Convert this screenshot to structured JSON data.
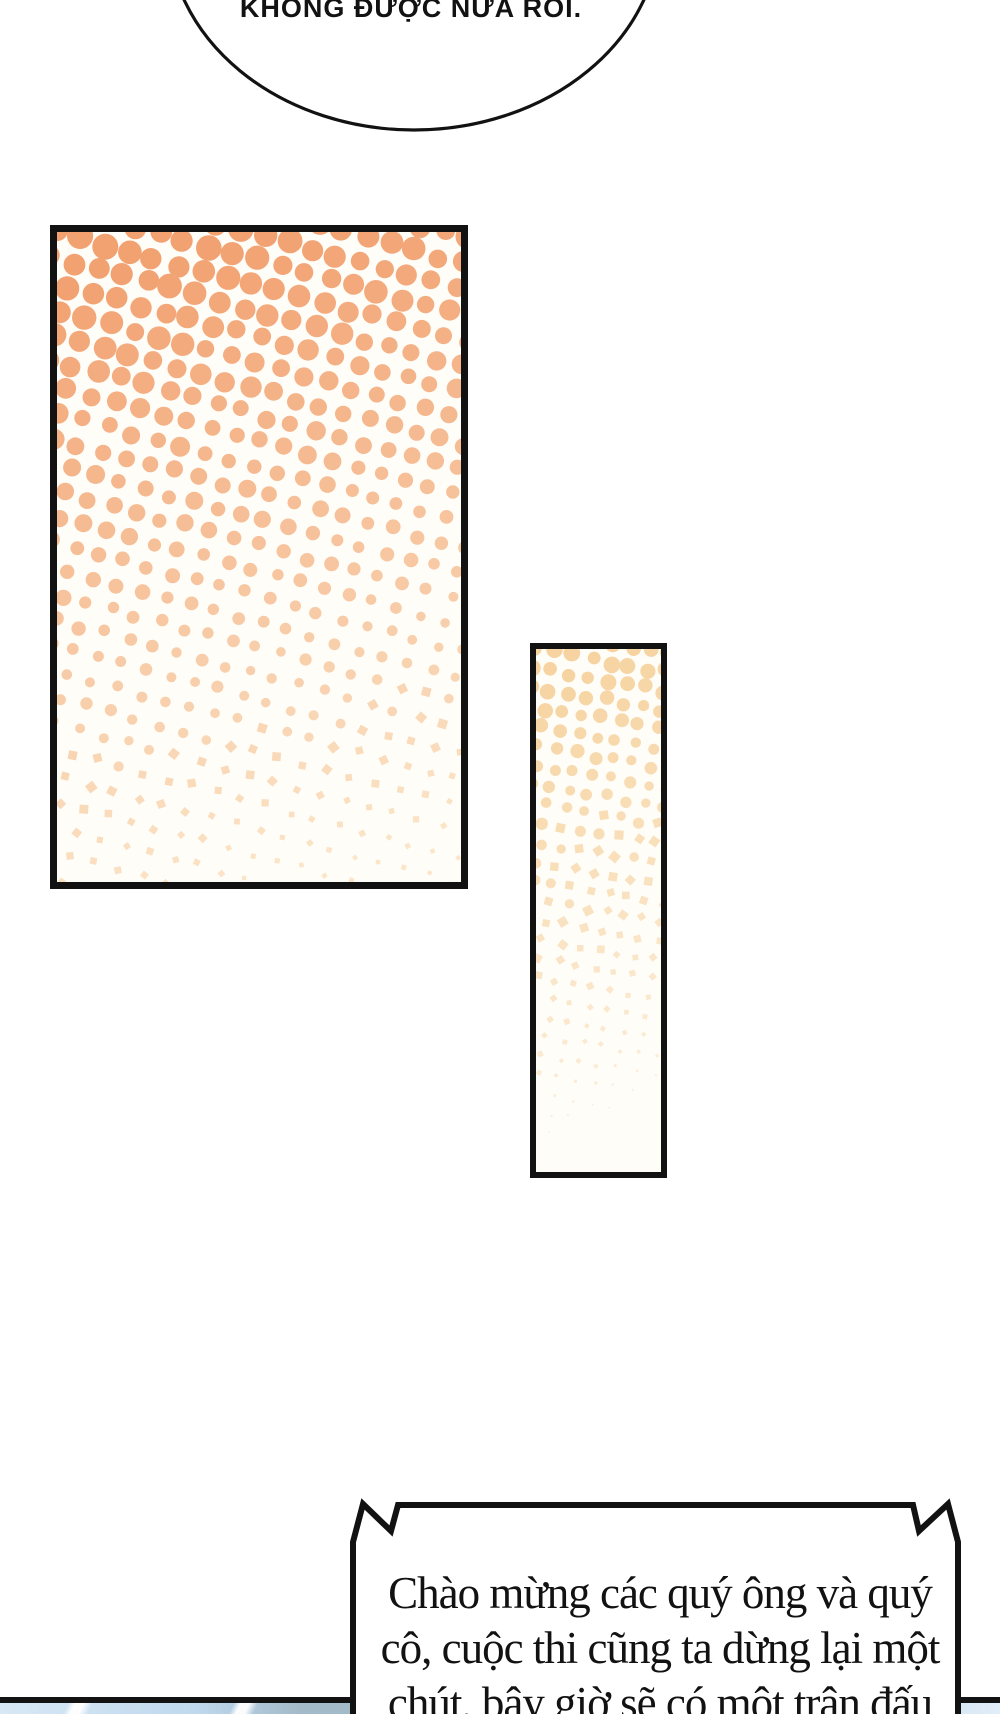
{
  "bubble": {
    "text": "KHÔNG ĐƯỢC NỮA RỒI."
  },
  "announcement": {
    "lines": [
      "Chào mừng các quý ông và quý",
      "cô, cuộc thi cũng ta dừng lại một",
      "chút, bây giờ sẽ có một trận đấu"
    ]
  },
  "halftone_panels": {
    "large": {
      "width": 404,
      "height": 650,
      "spacing": 25,
      "rotation": 15,
      "r_max": 11.5,
      "r_min": 2.4,
      "color_top": "#f2a171",
      "color_bottom": "#fbe6c9",
      "x_fade": 0.15,
      "vanish": false,
      "seed": 11
    },
    "small": {
      "width": 125,
      "height": 523,
      "spacing": 19,
      "rotation": 10,
      "r_max": 7.5,
      "r_min": 0.4,
      "color_top": "#f6d3a0",
      "color_bottom": "#fdf2e2",
      "x_fade": 0.1,
      "vanish": true,
      "seed": 5
    }
  },
  "colors": {
    "ink": "#121212",
    "paper": "#ffffff",
    "sky_light": "#d8e8f5",
    "sky_mid": "#c0d9ee",
    "sky_dark": "#a3bac9"
  }
}
